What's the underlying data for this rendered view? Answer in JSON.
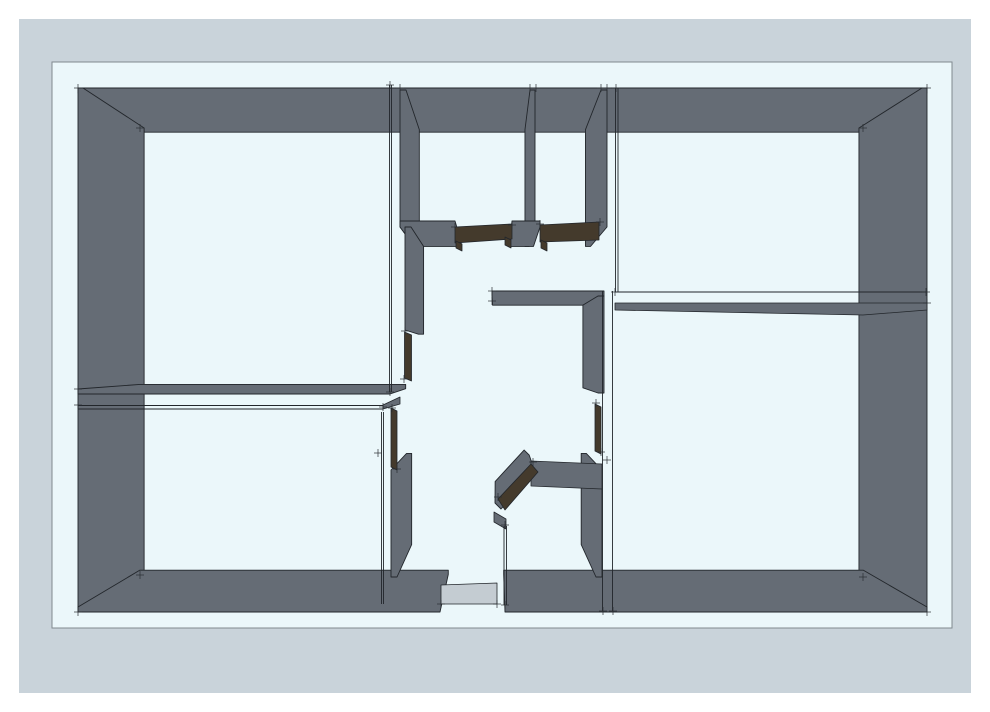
{
  "document": {
    "kind": "3d-floorplan-render",
    "description": "Perspective top view of an apartment floor plan with gray extruded walls on a pale blue sheet"
  },
  "colors": {
    "page": "#ffffff",
    "frame": "#c9d3da",
    "paper": "#ebf7fa",
    "paper_border": "#80888f",
    "wall": "#656c75",
    "line": "#22262b",
    "door": "#443a2c",
    "threshold": "#c4ccd2",
    "tick": "#2a2e33"
  },
  "canvas": {
    "page_w": 990,
    "page_h": 712
  },
  "frame": {
    "x": 19,
    "y": 19,
    "w": 952,
    "h": 674
  },
  "paper": {
    "x": 52,
    "y": 62,
    "w": 900,
    "h": 566
  },
  "projection": {
    "cx": 496,
    "cy": 358,
    "k": 0.148
  },
  "walls": [
    {
      "name": "wall-outer-north",
      "rect": [
        78,
        88,
        927,
        93
      ]
    },
    {
      "name": "wall-outer-west",
      "rect": [
        78,
        88,
        83,
        612
      ]
    },
    {
      "name": "wall-outer-east",
      "rect": [
        922,
        88,
        927,
        612
      ]
    },
    {
      "name": "wall-outer-south-left",
      "rect": [
        78,
        607,
        440,
        612
      ]
    },
    {
      "name": "wall-outer-south-right",
      "rect": [
        505,
        607,
        927,
        612
      ]
    },
    {
      "name": "wall-closet-west",
      "rect": [
        400,
        90,
        406,
        227
      ]
    },
    {
      "name": "wall-closet-divider",
      "rect": [
        530,
        90,
        535,
        227
      ]
    },
    {
      "name": "wall-closet-east",
      "rect": [
        601,
        90,
        607,
        227
      ]
    },
    {
      "name": "wall-hall-north-left",
      "rect": [
        400,
        221,
        455,
        227
      ]
    },
    {
      "name": "wall-hall-north-mid",
      "rect": [
        512,
        221,
        540,
        227
      ]
    },
    {
      "name": "wall-divider-left-upper",
      "rect": [
        78,
        389,
        390,
        394
      ]
    },
    {
      "name": "wall-hall-west-upper",
      "rect": [
        405,
        227,
        411,
        330
      ]
    },
    {
      "name": "wall-hall-west-lower",
      "rect": [
        391,
        470,
        397,
        577
      ]
    },
    {
      "name": "wall-hall-mid",
      "rect": [
        492,
        291,
        604,
        296
      ]
    },
    {
      "name": "wall-hall-east-upper",
      "rect": [
        598,
        296,
        604,
        393
      ]
    },
    {
      "name": "wall-hall-east-lower",
      "rect": [
        596,
        470,
        602,
        577
      ]
    }
  ],
  "wall_polys": [
    {
      "name": "wall-diagonal",
      "points": [
        [
          495,
          503
        ],
        [
          529,
          466
        ],
        [
          535,
          472
        ],
        [
          501,
          509
        ]
      ]
    }
  ],
  "overlays": [
    {
      "name": "wall-divider-right",
      "fill": "wall",
      "points": [
        [
          615,
          303
        ],
        [
          927,
          303
        ],
        [
          927,
          310
        ],
        [
          863,
          315
        ],
        [
          615,
          310
        ]
      ]
    },
    {
      "name": "wall-divider-left-lower-end",
      "fill": "wall",
      "points": [
        [
          383,
          405
        ],
        [
          400,
          397
        ],
        [
          400,
          404
        ],
        [
          383,
          409
        ]
      ]
    },
    {
      "name": "wall-mid-room-north",
      "fill": "wall",
      "points": [
        [
          531,
          461
        ],
        [
          602,
          464
        ],
        [
          602,
          489
        ],
        [
          531,
          486
        ]
      ]
    },
    {
      "name": "door-header-closet-left",
      "fill": "door",
      "points": [
        [
          455,
          227
        ],
        [
          512,
          224
        ],
        [
          512,
          239
        ],
        [
          455,
          243
        ]
      ]
    },
    {
      "name": "door-jamb-closet-left-a",
      "fill": "door",
      "points": [
        [
          456,
          241
        ],
        [
          462,
          244
        ],
        [
          462,
          251
        ],
        [
          456,
          248
        ]
      ]
    },
    {
      "name": "door-jamb-closet-left-b",
      "fill": "door",
      "points": [
        [
          505,
          237
        ],
        [
          511,
          240
        ],
        [
          511,
          248
        ],
        [
          505,
          245
        ]
      ]
    },
    {
      "name": "door-header-closet-right",
      "fill": "door",
      "points": [
        [
          540,
          225
        ],
        [
          599,
          222
        ],
        [
          599,
          240
        ],
        [
          540,
          242
        ]
      ]
    },
    {
      "name": "door-jamb-closet-right",
      "fill": "door",
      "points": [
        [
          541,
          240
        ],
        [
          547,
          243
        ],
        [
          547,
          251
        ],
        [
          541,
          248
        ]
      ]
    },
    {
      "name": "door-hall-west-upper",
      "fill": "door",
      "points": [
        [
          404.5,
          332
        ],
        [
          411.5,
          335
        ],
        [
          411.5,
          381
        ],
        [
          404.5,
          378
        ]
      ]
    },
    {
      "name": "door-hall-west-lower",
      "fill": "door",
      "points": [
        [
          391,
          408
        ],
        [
          397,
          411
        ],
        [
          397,
          470
        ],
        [
          391,
          467
        ]
      ]
    },
    {
      "name": "door-hall-east",
      "fill": "door",
      "points": [
        [
          595,
          404
        ],
        [
          601,
          407
        ],
        [
          601,
          454
        ],
        [
          595,
          451
        ]
      ]
    },
    {
      "name": "door-diagonal",
      "fill": "door",
      "points": [
        [
          498,
          499
        ],
        [
          531,
          464
        ],
        [
          538,
          472
        ],
        [
          505,
          510
        ]
      ]
    },
    {
      "name": "wall-sliver-mid-west",
      "fill": "wall",
      "points": [
        [
          494,
          512
        ],
        [
          506,
          519
        ],
        [
          506,
          529
        ],
        [
          494,
          522
        ]
      ]
    },
    {
      "name": "threshold-entry",
      "fill": "threshold",
      "points": [
        [
          441,
          585
        ],
        [
          497,
          583
        ],
        [
          497,
          604
        ],
        [
          441,
          604
        ]
      ]
    }
  ],
  "edges": [
    {
      "name": "edge-room1-east-a",
      "line": [
        389.5,
        85,
        389.5,
        392
      ]
    },
    {
      "name": "edge-room1-east-b",
      "line": [
        391.5,
        85,
        391.5,
        392
      ]
    },
    {
      "name": "edge-room2-west-a",
      "line": [
        615.5,
        88,
        615.5,
        292
      ]
    },
    {
      "name": "edge-room2-west-b",
      "line": [
        618,
        88,
        618,
        292
      ]
    },
    {
      "name": "edge-divider-right-top",
      "line": [
        615,
        292,
        926,
        292
      ]
    },
    {
      "name": "edge-corridor-a",
      "line": [
        602.5,
        291,
        602.5,
        611
      ]
    },
    {
      "name": "edge-corridor-b",
      "line": [
        612.5,
        291,
        612.5,
        611
      ]
    },
    {
      "name": "edge-room4-east-a",
      "line": [
        381.5,
        412,
        381.5,
        604
      ]
    },
    {
      "name": "edge-room4-east-b",
      "line": [
        383.5,
        412,
        383.5,
        604
      ]
    },
    {
      "name": "edge-divider-left-lower-a",
      "line": [
        78,
        405.5,
        383,
        405.5
      ]
    },
    {
      "name": "edge-divider-left-lower-b",
      "line": [
        78,
        409,
        383,
        409
      ]
    },
    {
      "name": "edge-mid-room-west-a",
      "line": [
        504,
        526,
        504,
        605
      ]
    },
    {
      "name": "edge-mid-room-west-b",
      "line": [
        506.5,
        526,
        506.5,
        605
      ]
    }
  ],
  "ticks": [
    [
      78,
      88
    ],
    [
      927,
      88
    ],
    [
      78,
      612
    ],
    [
      927,
      612
    ],
    [
      140,
      128
    ],
    [
      863,
      128
    ],
    [
      140,
      575
    ],
    [
      863,
      577
    ],
    [
      390,
      85
    ],
    [
      400,
      88
    ],
    [
      530,
      88
    ],
    [
      536,
      88
    ],
    [
      601,
      88
    ],
    [
      607,
      88
    ],
    [
      616,
      88
    ],
    [
      455,
      227
    ],
    [
      512,
      225
    ],
    [
      540,
      224
    ],
    [
      600,
      222
    ],
    [
      492,
      291
    ],
    [
      492,
      301
    ],
    [
      615,
      292
    ],
    [
      926,
      292
    ],
    [
      78,
      389
    ],
    [
      78,
      405
    ],
    [
      390,
      392
    ],
    [
      383,
      407
    ],
    [
      405,
      331
    ],
    [
      404,
      379
    ],
    [
      392,
      408
    ],
    [
      397,
      469
    ],
    [
      596,
      403
    ],
    [
      601,
      452
    ],
    [
      441,
      604
    ],
    [
      497,
      604
    ],
    [
      505,
      605
    ],
    [
      603,
      611
    ],
    [
      613,
      611
    ],
    [
      533,
      462
    ],
    [
      498,
      497
    ],
    [
      505,
      525
    ],
    [
      607,
      460
    ],
    [
      927,
      303
    ],
    [
      378,
      453
    ]
  ]
}
